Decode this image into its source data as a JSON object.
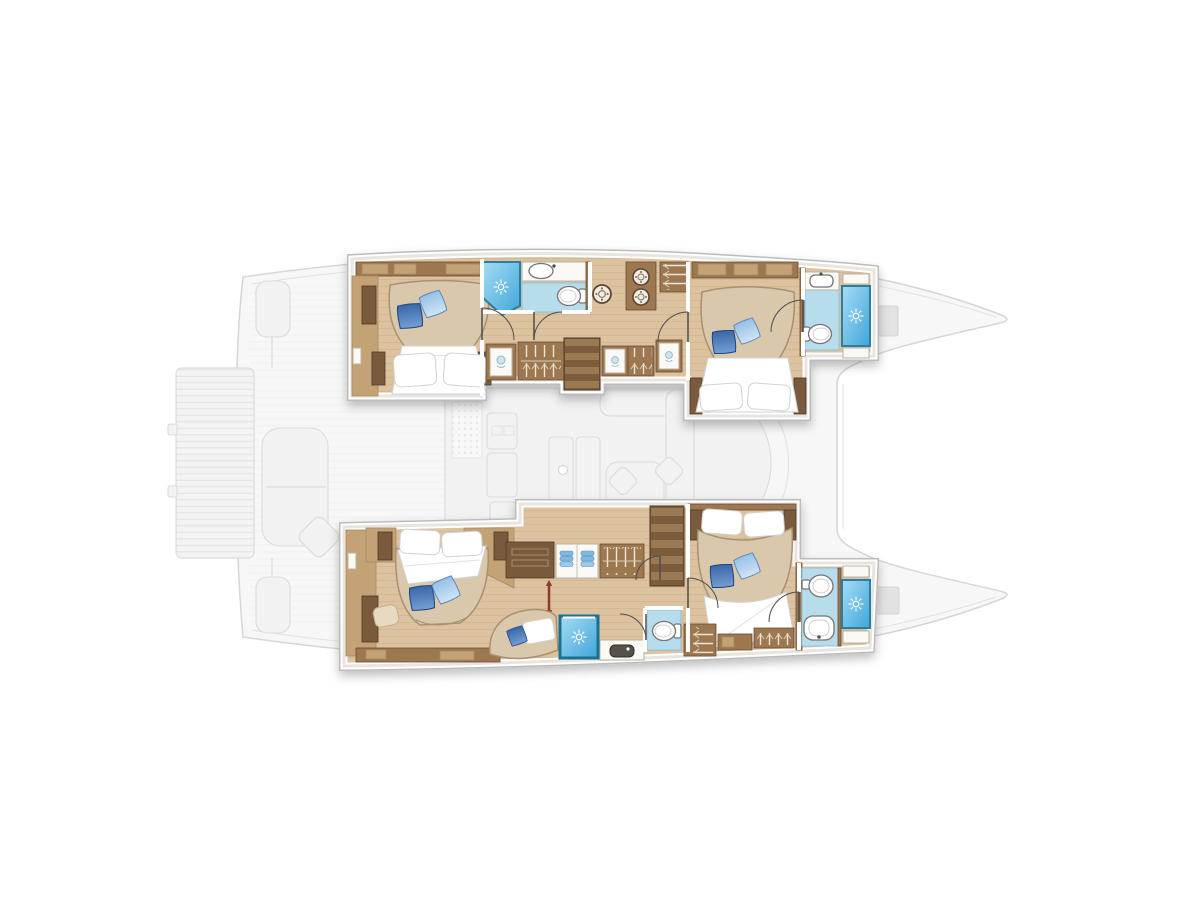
{
  "meta": {
    "title": "Catamaran yacht lower-deck floor plan, top-down view, bow to the right",
    "diagram_type": "floor-plan",
    "bow_direction": "right",
    "no_visible_text": true
  },
  "palette": {
    "paper": "#ffffff",
    "hull_line": "#d6d6d6",
    "hull_fill": "#f7f7f7",
    "faded_line": "#dcdcdc",
    "faded_fill": "#f2f2f2",
    "faded_dark": "#e2e2e2",
    "wall_white": "#ffffff",
    "wall_edge": "#bcbcbc",
    "wood_floor": "#dcc29e",
    "wood_plank_line": "#c9ab83",
    "wood_dark": "#7a5a3d",
    "wood_mid": "#9c7750",
    "wood_light": "#c3a276",
    "bed_tan": "#d9c8ab",
    "bed_tan_edge": "#a89071",
    "linen": "#ffffff",
    "linen_edge": "#d2d2d2",
    "pillow_dark_a": "#1f4f96",
    "pillow_dark_b": "#8fb6e4",
    "pillow_light_a": "#7cb0e0",
    "pillow_light_b": "#e9f4fd",
    "shower_a": "#3fa6da",
    "shower_b": "#a6dcf4",
    "shower_edge": "#2a7fa0",
    "bath_floor": "#b7dcec",
    "bath_floor_edge": "#8fc3dc",
    "porcelain_line": "#747474",
    "door_line": "#4d4d4d",
    "stair_a": "#9a7a52",
    "stair_b": "#7d5c3a",
    "towel_blue": "#7fb8e0",
    "accent_red": "#8e3a2a",
    "hanger_line": "#efe8d8"
  },
  "counts": {
    "cabins": 4,
    "double_beds": 4,
    "bathrooms": 4,
    "showers": 4,
    "toilets": 4,
    "washbasins": 4,
    "staircases": 2,
    "washer_dryer_drums": 3,
    "blue_throw_pillows": 9
  },
  "vessel": {
    "main_deck_faded": {
      "label": "Main deck shown as faded grey reference",
      "elements": [
        "hull silhouette",
        "swim platform with teak stripes",
        "stern steps",
        "aft cockpit bench and cushion",
        "saloon outline",
        "windshield curve",
        "galley counters",
        "saloon mat",
        "saloon tables",
        "L-shaped sofa",
        "mast foot",
        "forward crossbeam lines",
        "foredeck hatch port",
        "foredeck hatch starboard"
      ]
    },
    "lower_deck": {
      "hull_top": {
        "label": "Upper hull - two guest suites with corridor and laundry",
        "rooms": [
          {
            "id": "cabin-a-aft",
            "label": "Aft guest cabin, island double bed with two blue throw pillows",
            "features": [
              "double bed",
              "white duvet and pillows",
              "overhead lockers",
              "wardrobe column",
              "two bedside cabinets"
            ]
          },
          {
            "id": "bath-a-aft",
            "label": "Aft en-suite bathroom",
            "features": [
              "corner shower with spray icon",
              "washbasin counter",
              "toilet",
              "blue tiled floor"
            ]
          },
          {
            "id": "corridor-a",
            "label": "Companionway corridor with laundry and wardrobes",
            "features": [
              "porthole washer drum",
              "stacked washer-dryer drums",
              "three hanging wardrobes",
              "three vanity panels",
              "staircase to saloon"
            ]
          },
          {
            "id": "cabin-a-fwd",
            "label": "Forward guest cabin, island double bed with two blue throw pillows",
            "features": [
              "double bed",
              "white duvet and pillows",
              "overhead lockers",
              "bedside posts"
            ]
          },
          {
            "id": "bath-a-fwd",
            "label": "Bow bathroom",
            "features": [
              "shower cubicle with spray icon",
              "washbasin",
              "toilet",
              "storage shelves",
              "blue tiled floor"
            ]
          }
        ]
      },
      "hull_bottom": {
        "label": "Lower hull - owner suite aft plus forward guest suite",
        "rooms": [
          {
            "id": "cabin-b-master",
            "label": "Owner cabin, island double bed with two blue throw pillows",
            "features": [
              "double bed",
              "white head pillows",
              "duvet fold",
              "pouf",
              "wardrobe column",
              "low cabinet run"
            ]
          },
          {
            "id": "lounge-b",
            "label": "Owner dressing and lounge area",
            "features": [
              "dresser",
              "towel shelves",
              "hanging wardrobe",
              "chaise with blue pillow",
              "red handrail post",
              "staircase to saloon"
            ]
          },
          {
            "id": "bath-b-mid",
            "label": "Owner bathroom",
            "features": [
              "large shower with spray icon",
              "dark basin vanity",
              "separate toilet room",
              "blue tiled floor"
            ]
          },
          {
            "id": "cabin-b-fwd",
            "label": "Forward guest cabin, island double bed with two blue throw pillows",
            "features": [
              "double bed",
              "white duvet sweep",
              "two hanging wardrobes",
              "shelf unit"
            ]
          },
          {
            "id": "bath-b-fwd",
            "label": "Bow bathroom",
            "features": [
              "shower cubicle with spray icon",
              "round washbasin",
              "toilet",
              "storage shelves",
              "blue tiled floor"
            ]
          }
        ]
      }
    }
  },
  "icons": {
    "shower_spray": "white starburst on blue",
    "washer_drum": "double-ring porthole with dots",
    "wardrobe": "hanger strokes on rail",
    "stairs": "striped treads",
    "door": "quarter-circle swing arc",
    "handrail": "red post with arrow tips"
  }
}
